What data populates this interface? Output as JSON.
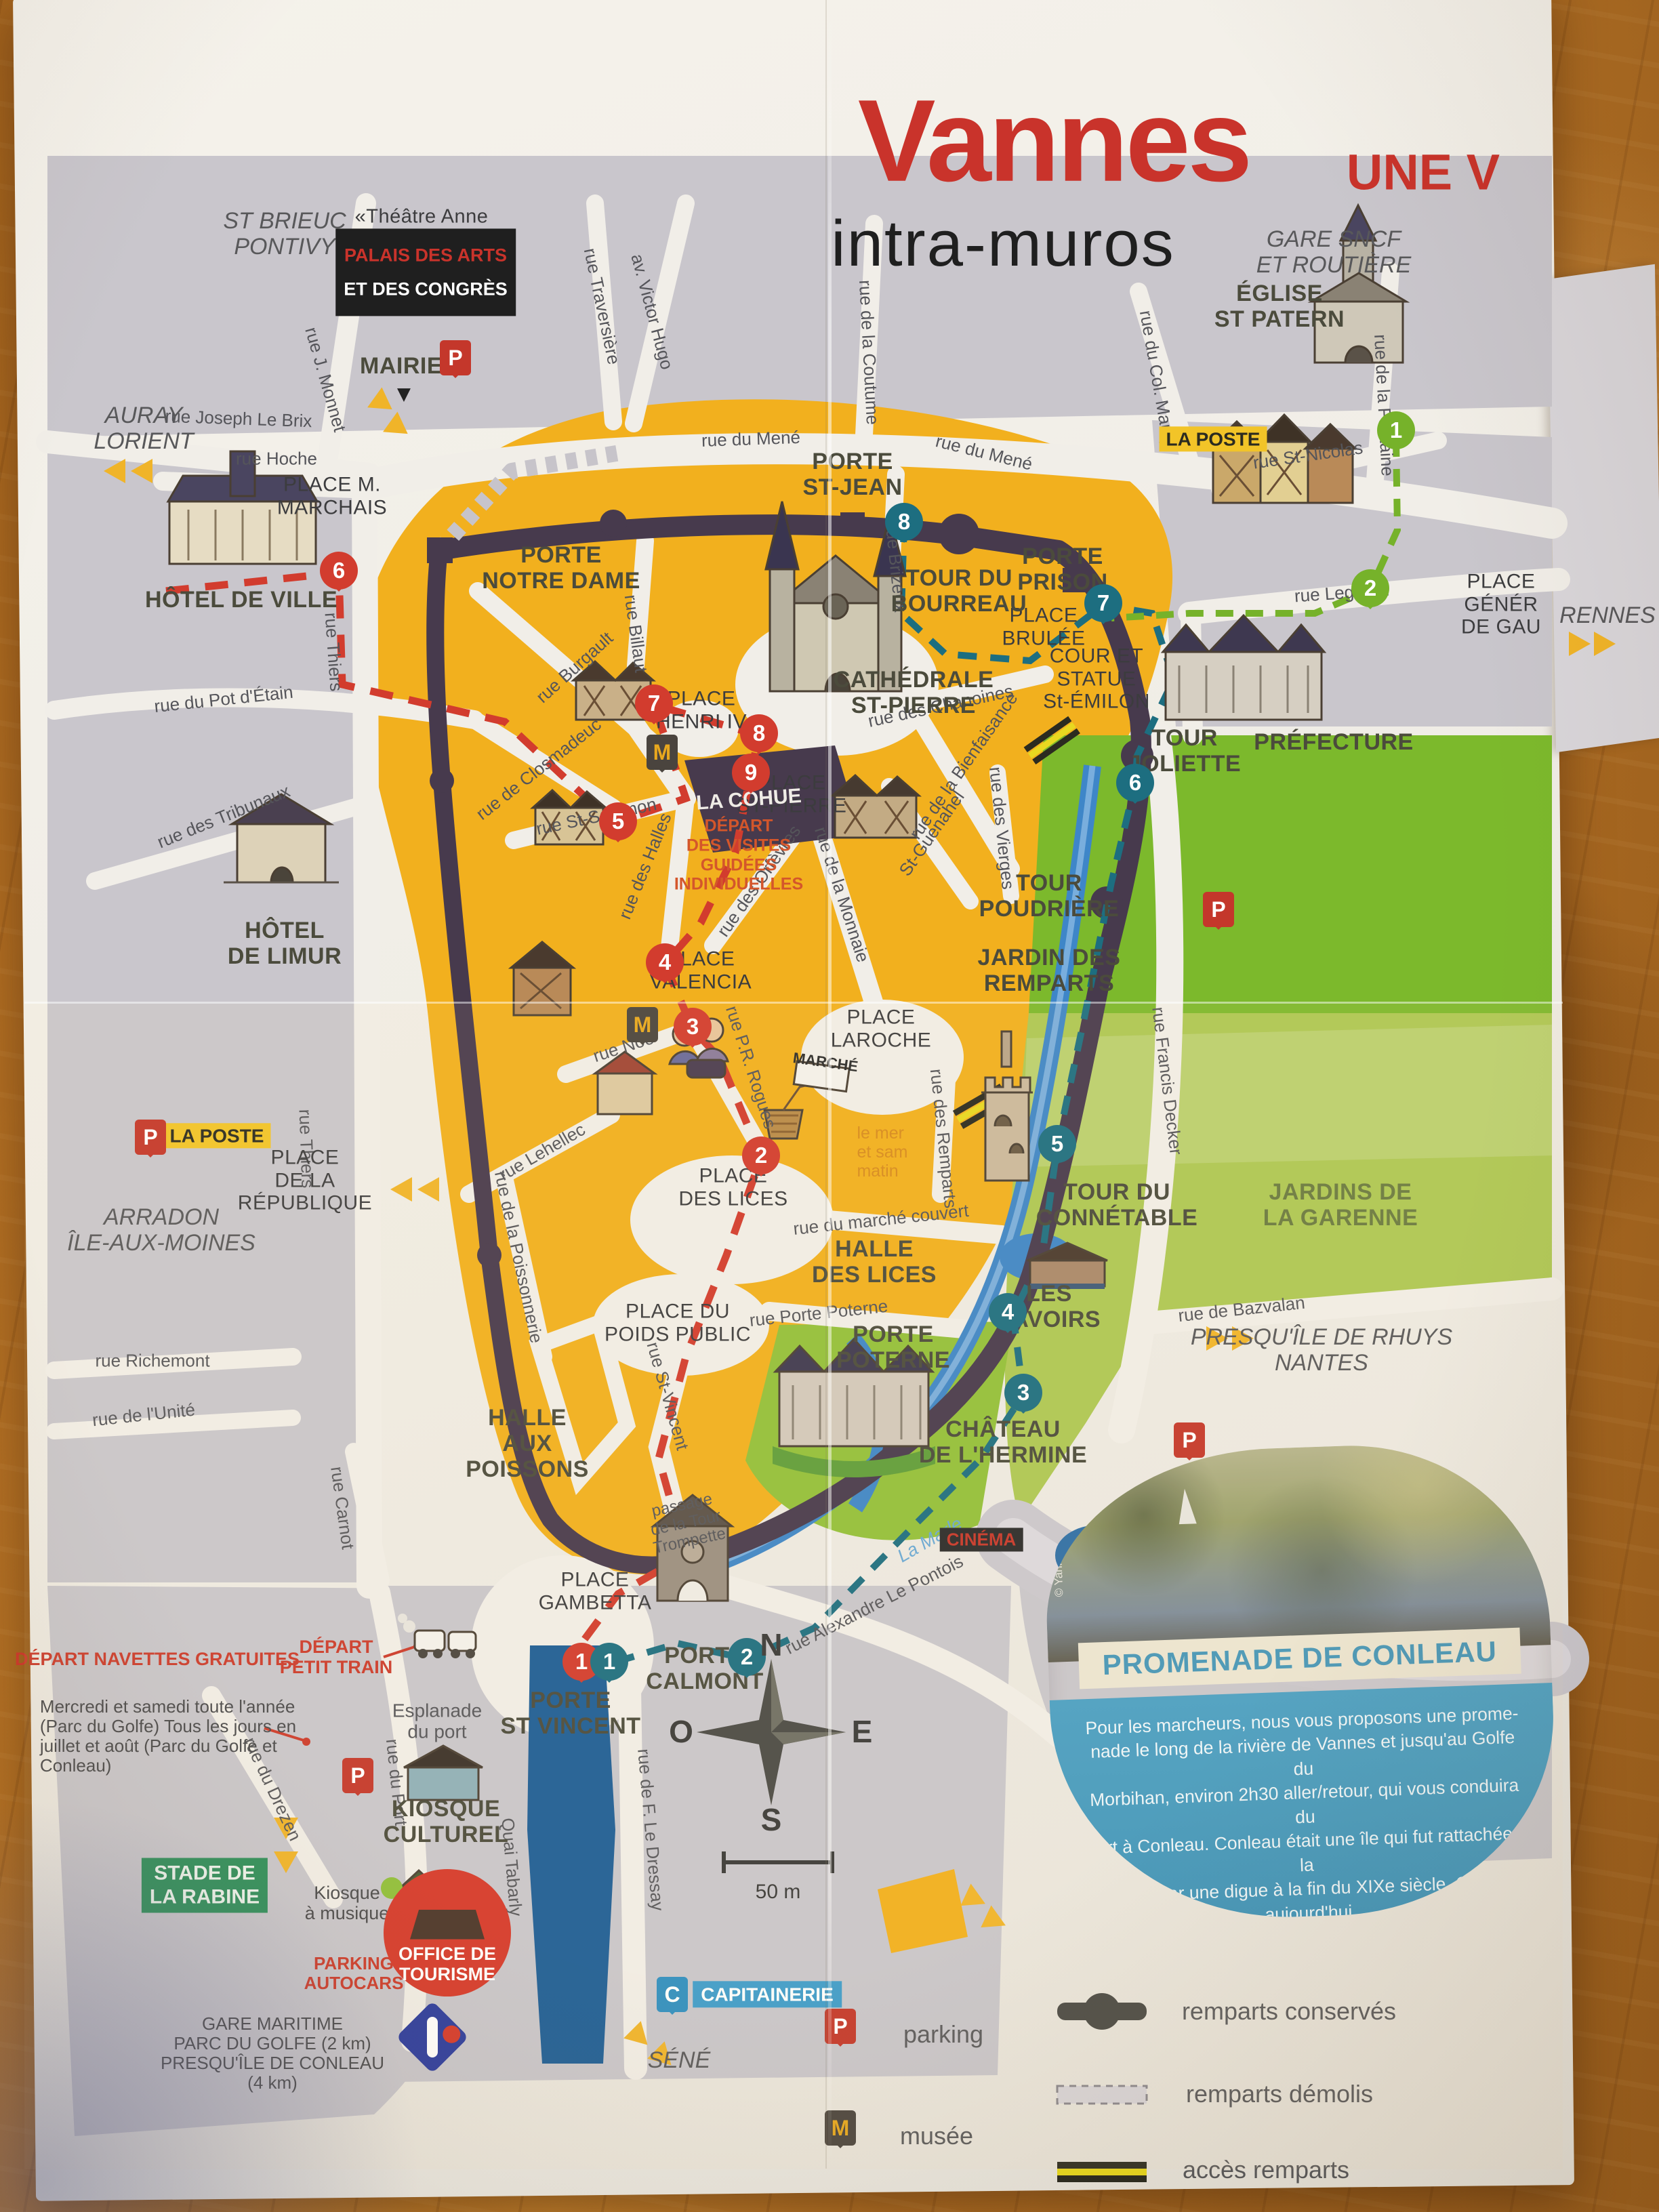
{
  "header": {
    "title": "Vannes",
    "edge_text": "UNE V",
    "subtitle": "intra-muros"
  },
  "directions": {
    "st_brieuc": "ST BRIEUC\nPONTIVY",
    "auray": "AURAY\nLORIENT",
    "arradon": "ARRADON\nÎLE-AUX-MOINES",
    "rennes": "RENNES",
    "gare_sncf": "GARE SNCF\nET ROUTIÈRE",
    "presquile": "PRESQU'ÎLE DE RHUYS\nNANTES",
    "sene": "SÉNÉ",
    "gare_maritime": "GARE MARITIME\nPARC DU GOLFE (2 km)\nPRESQU'ÎLE DE CONLEAU\n(4 km)"
  },
  "streets": [
    "rue J. Monnet",
    "rue Joseph Le Brix",
    "rue Hoche",
    "rue Traversière",
    "av. Victor Hugo",
    "rue de la Coutume",
    "rue du Mené",
    "rue du Col. Maury",
    "rue de la Fontaine",
    "rue St-Nicolas",
    "rue Legrand",
    "rue Thiers",
    "rue du Pot d'Étain",
    "rue des Tribunaux",
    "rue de Closmadeuc",
    "rue St-Salomon",
    "rue des Halles",
    "rue Burgault",
    "rue Billaut",
    "rue Brizeux",
    "rue des Chanoines",
    "St-Guenahel",
    "rue de la Bienfaisance",
    "rue des Vierges",
    "rue de la Monnaie",
    "rue des Orfèvres",
    "rue Noé",
    "rue P.R. Rogues",
    "rue Lehellec",
    "rue de la Poissonnerie",
    "rue St-Vincent",
    "rue des Remparts",
    "rue du marché couvert",
    "rue Porte Poterne",
    "rue Francis Decker",
    "rue de Bazvalan",
    "rue Alexandre Le Pontois",
    "rue Richemont",
    "rue de l'Unité",
    "rue Carnot",
    "rue du Drezen",
    "rue du Port",
    "Quai Tabarly",
    "rue de F. Le Dressay",
    "La Marle",
    "passage\nde la Tour\nTrompette",
    "Esplanade\ndu port"
  ],
  "places": [
    "PLACE M.\nMARCHAIS",
    "PLACE\nHENRI IV",
    "PLACE\nST-PIERRE",
    "PLACE\nVALENCIA",
    "PLACE\nLAROCHE",
    "PLACE\nDES LICES",
    "PLACE DU\nPOIDS PUBLIC",
    "PLACE\nDE LA\nRÉPUBLIQUE",
    "PLACE\nBRULÉE",
    "COUR ET\nSTATUE\nSt-ÉMILON",
    "PLACE\nGÉNÉR\nDE GAU",
    "PLACE\nGAMBETTA"
  ],
  "monuments": {
    "mairie": "MAIRIE",
    "eglise_st_patern": "ÉGLISE\nST PATERN",
    "hotel_de_ville": "HÔTEL DE VILLE",
    "hotel_de_limur": "HÔTEL\nDE LIMUR",
    "porte_notre_dame": "PORTE\nNOTRE DAME",
    "porte_st_jean": "PORTE\nST-JEAN",
    "tour_du_bourreau": "TOUR DU\nBOURREAU",
    "porte_prison": "PORTE\nPRISON",
    "cathedrale": "CATHÉDRALE\nST-PIERRE",
    "la_cohue": "LA COHUE",
    "tour_joliette": "TOUR\nJOLIETTE",
    "prefecture": "PRÉFECTURE",
    "tour_poudriere": "TOUR\nPOUDRIÈRE",
    "jardin_des_remparts": "JARDIN DES\nREMPARTS",
    "tour_du_connetable": "TOUR DU\nCONNÉTABLE",
    "les_lavoirs": "LES\nLAVOIRS",
    "jardins_de_la_garenne": "JARDINS DE\nLA GARENNE",
    "halle_des_lices": "HALLE\nDES LICES",
    "porte_poterne": "PORTE\nPOTERNE",
    "chateau_hermine": "CHÂTEAU\nDE L'HERMINE",
    "porte_calmont": "PORTE\nCALMONT",
    "porte_st_vincent": "PORTE\nST VINCENT",
    "halle_aux_poissons": "HALLE\nAUX\nPOISSONS",
    "kiosque_culturel": "KIOSQUE\nCULTUREL",
    "stade_de_la_rabine": "STADE DE\nLA RABINE"
  },
  "labels": {
    "theatre": "«Théâtre Anne\nde Bretagne»",
    "palais_1": "PALAIS DES ARTS",
    "palais_2": "ET DES CONGRÈS",
    "la_poste": "LA POSTE",
    "depart_visites": "DÉPART\nDES VISITES\nGUIDÉES\nINDIVIDUELLES",
    "marche_sign": "MARCHÉ",
    "marche_note": "le mer\net sam\nmatin",
    "cinema": "CINÉMA",
    "capitainerie": "CAPITAINERIE",
    "kiosque_musique": "Kiosque\nà musique",
    "parking_autocars": "PARKING\nAUTOCARS",
    "office_tourisme": "OFFICE DE\nTOURISME",
    "depart_navettes": "DÉPART NAVETTES GRATUITES",
    "navettes_detail": "Mercredi et samedi toute l'année\n(Parc du Golfe) Tous les jours en\njuillet et août (Parc du Golfe et\nConleau)",
    "depart_petit_train": "DÉPART\nPETIT TRAIN"
  },
  "markers": {
    "red": [
      "1",
      "2",
      "3",
      "4",
      "5",
      "6",
      "7",
      "8",
      "9"
    ],
    "teal": [
      "1",
      "2",
      "3",
      "4",
      "5",
      "6",
      "7",
      "8"
    ],
    "green": [
      "1",
      "2"
    ],
    "letters": {
      "p": "P",
      "m": "M",
      "c": "C"
    }
  },
  "legend": {
    "parking": "parking",
    "musee": "musée",
    "remparts_conserves": "remparts conservés",
    "remparts_demolis": "remparts démolis",
    "acces_remparts": "accès remparts"
  },
  "compass": {
    "n": "N",
    "e": "E",
    "s": "S",
    "o": "O"
  },
  "scale_label": "50 m",
  "promenade": {
    "title": "PROMENADE DE CONLEAU",
    "credit": "© Yannick Le Gal",
    "text": "Pour les marcheurs, nous vous proposons une prome-\nnade le long de la rivière de Vannes et jusqu'au Golfe du\nMorbihan, environ 2h30 aller/retour, qui vous conduira du\nPort à Conleau. Conleau était une île qui fut rattachée à la\ncôte par une digue à la fin du XIXe siècle. C'est aujourd'hui\nune promenade très appréciée des Vannetais, c'est aussi\nla seule plage de la ville, et l'embarcadère pour l'île d'Arz\n(d'octobre à mars)."
  },
  "colors": {
    "title_red": "#c9332b",
    "map_yellow": "#f2b01e",
    "block_gray": "#c9c6cc",
    "wall_dark": "#473a4d",
    "park_green": "#7cb92c",
    "river_blue": "#3e86c8",
    "port_blue": "#1d5d96",
    "route_red": "#d23c2e",
    "route_teal": "#1d6e80",
    "route_green": "#76b22a",
    "arrow_yellow": "#f0b429",
    "paper": "#f0ede6",
    "wood": "#b06c24"
  }
}
